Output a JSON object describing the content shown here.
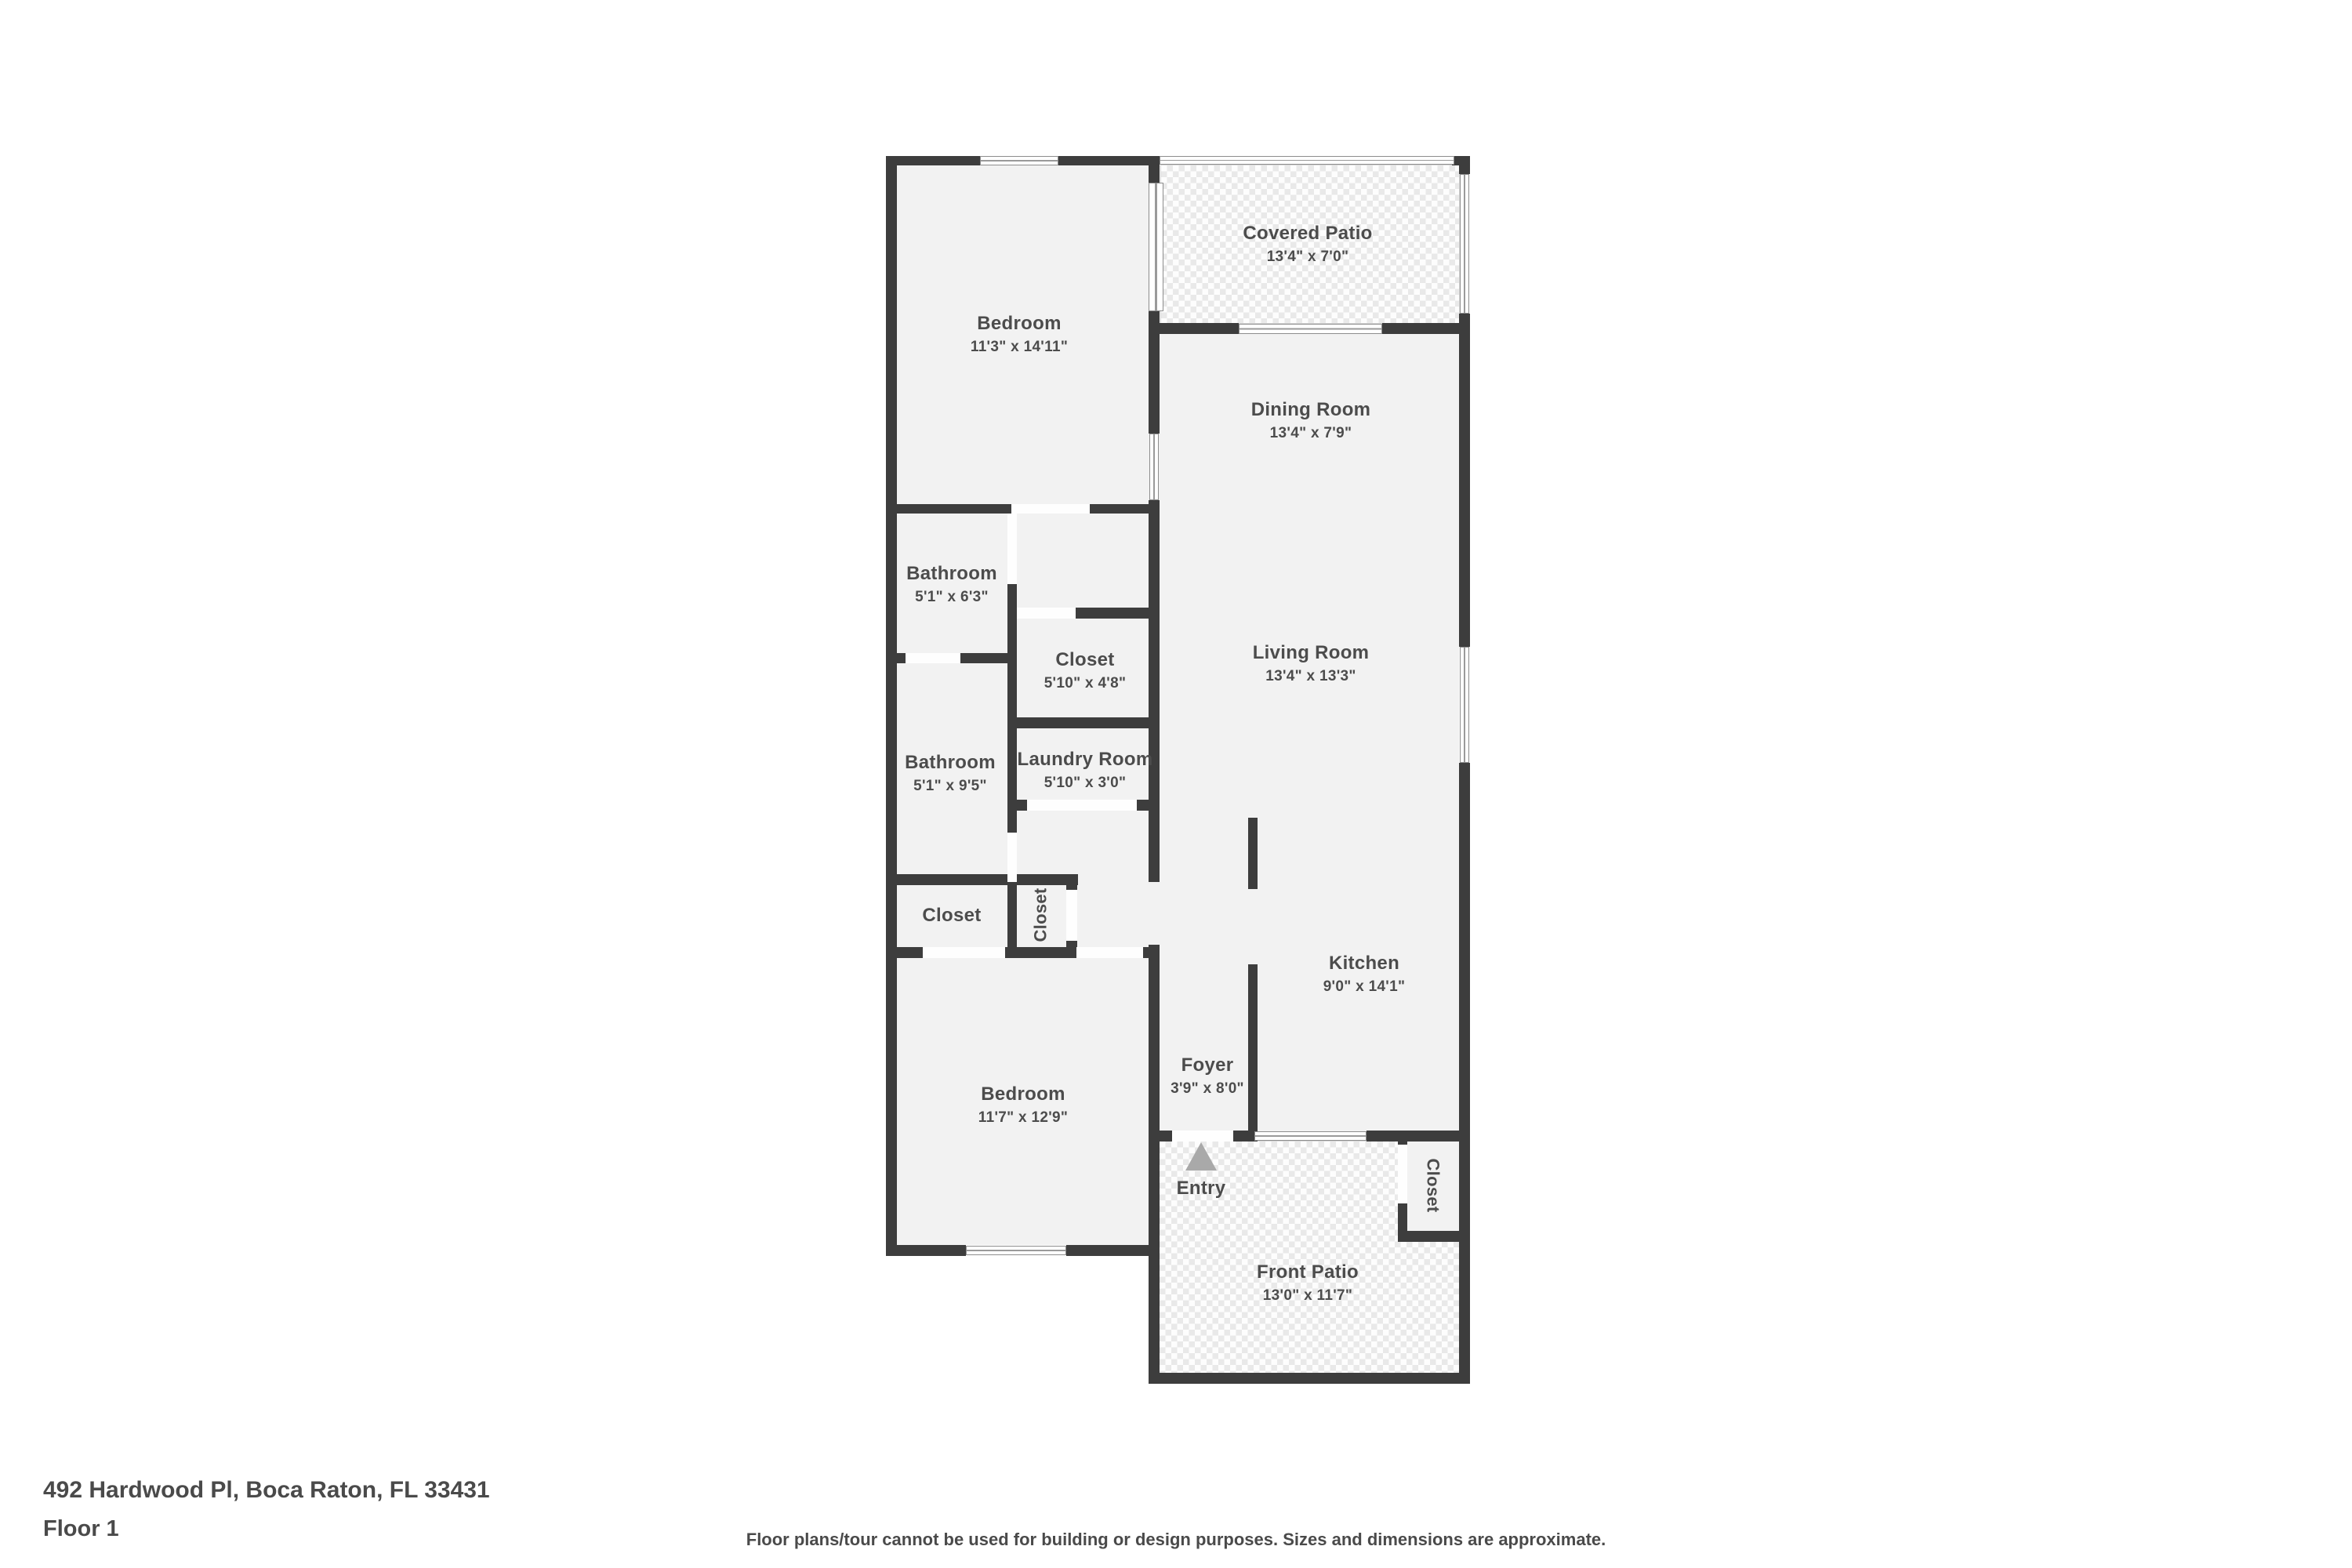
{
  "theme": {
    "wall_color": "#3d3d3d",
    "room_fill": "#f2f2f2",
    "label_color": "#4c4c4c",
    "entry_arrow_color": "#a9a9a9"
  },
  "rooms": {
    "covered_patio": {
      "name": "Covered Patio",
      "dims": "13'4\" x 7'0\""
    },
    "bedroom_top": {
      "name": "Bedroom",
      "dims": "11'3\" x 14'11\""
    },
    "dining_room": {
      "name": "Dining Room",
      "dims": "13'4\" x 7'9\""
    },
    "living_room": {
      "name": "Living Room",
      "dims": "13'4\" x 13'3\""
    },
    "bathroom_top": {
      "name": "Bathroom",
      "dims": "5'1\" x 6'3\""
    },
    "closet_mid": {
      "name": "Closet",
      "dims": "5'10\" x 4'8\""
    },
    "bathroom_mid": {
      "name": "Bathroom",
      "dims": "5'1\" x 9'5\""
    },
    "laundry_room": {
      "name": "Laundry Room",
      "dims": "5'10\" x 3'0\""
    },
    "kitchen": {
      "name": "Kitchen",
      "dims": "9'0\" x 14'1\""
    },
    "closet_hall_left": {
      "name": "Closet"
    },
    "closet_hall_vertical": {
      "name": "Closet"
    },
    "bedroom_bottom": {
      "name": "Bedroom",
      "dims": "11'7\" x 12'9\""
    },
    "foyer": {
      "name": "Foyer",
      "dims": "3'9\" x 8'0\""
    },
    "entry": {
      "name": "Entry"
    },
    "closet_entry": {
      "name": "Closet"
    },
    "front_patio": {
      "name": "Front Patio",
      "dims": "13'0\" x 11'7\""
    }
  },
  "footer": {
    "address": "492 Hardwood Pl, Boca Raton, FL 33431",
    "floor_label": "Floor 1",
    "disclaimer": "Floor plans/tour cannot be used for building or design purposes. Sizes and dimensions are approximate."
  }
}
